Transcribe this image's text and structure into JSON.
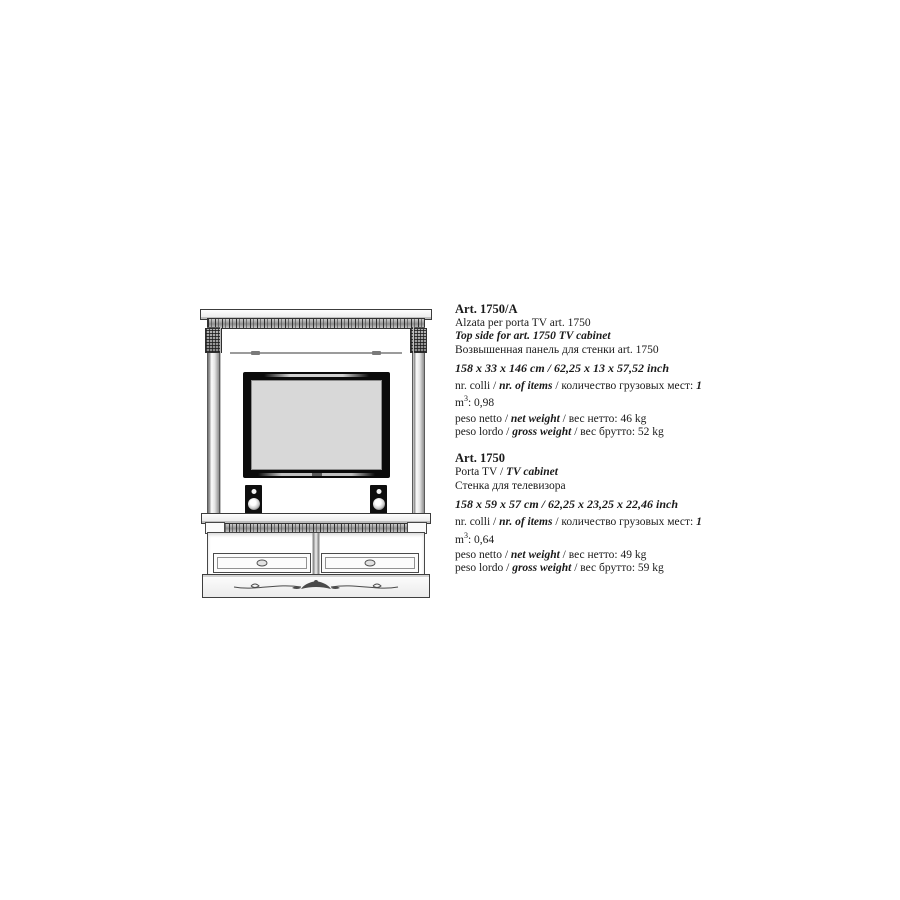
{
  "page": {
    "background": "#ffffff",
    "ink_color": "#1a1a1a"
  },
  "drawing": {
    "alt": "Line drawing of classical TV wall unit: carved cornice top panel with columns, glass shelf, TV with two speakers, lower cabinet with two drawers and carved plinth",
    "tv_screen_color": "#d8d8d8",
    "line_color": "#4a4a4a"
  },
  "products": [
    {
      "code": "Art. 1750/A",
      "name_it": "Alzata per porta TV art. 1750",
      "name_en": "Top side for art. 1750 TV cabinet",
      "name_ru": "Возвышенная панель для стенки art. 1750",
      "dimensions": "158 x 33 x 146 cm / 62,25 x 13 x 57,52 inch",
      "items_label_it": "nr. colli / ",
      "items_label_en": "nr. of items",
      "items_sep": " / ",
      "items_label_ru": "количество грузовых мест: ",
      "items_value": "1",
      "volume_label": "m",
      "volume_sup": "3",
      "volume_sep": ": ",
      "volume_value": "0,98",
      "net_label_it": "peso netto / ",
      "net_label_en": "net weight",
      "net_sep": " / ",
      "net_label_ru": "вес нетто: ",
      "net_value": "46 kg",
      "gross_label_it": "peso lordo / ",
      "gross_label_en": "gross weight",
      "gross_sep": " / ",
      "gross_label_ru": "вес брутто: ",
      "gross_value": "52 kg"
    },
    {
      "code": "Art. 1750",
      "name_it": "Porta TV",
      "name_sep": " / ",
      "name_en": "TV cabinet",
      "name_ru": "Стенка  для телевизора",
      "dimensions": "158 x 59 x 57 cm / 62,25 x 23,25 x 22,46 inch",
      "items_label_it": "nr. colli / ",
      "items_label_en": "nr. of items",
      "items_sep": " / ",
      "items_label_ru": "количество грузовых мест: ",
      "items_value": "1",
      "volume_label": "m",
      "volume_sup": "3",
      "volume_sep": ": ",
      "volume_value": "0,64",
      "net_label_it": "peso netto / ",
      "net_label_en": "net weight",
      "net_sep": " / ",
      "net_label_ru": "вес нетто: ",
      "net_value": "49 kg",
      "gross_label_it": "peso lordo / ",
      "gross_label_en": "gross weight",
      "gross_sep": " / ",
      "gross_label_ru": "вес брутто: ",
      "gross_value": "59 kg"
    }
  ]
}
